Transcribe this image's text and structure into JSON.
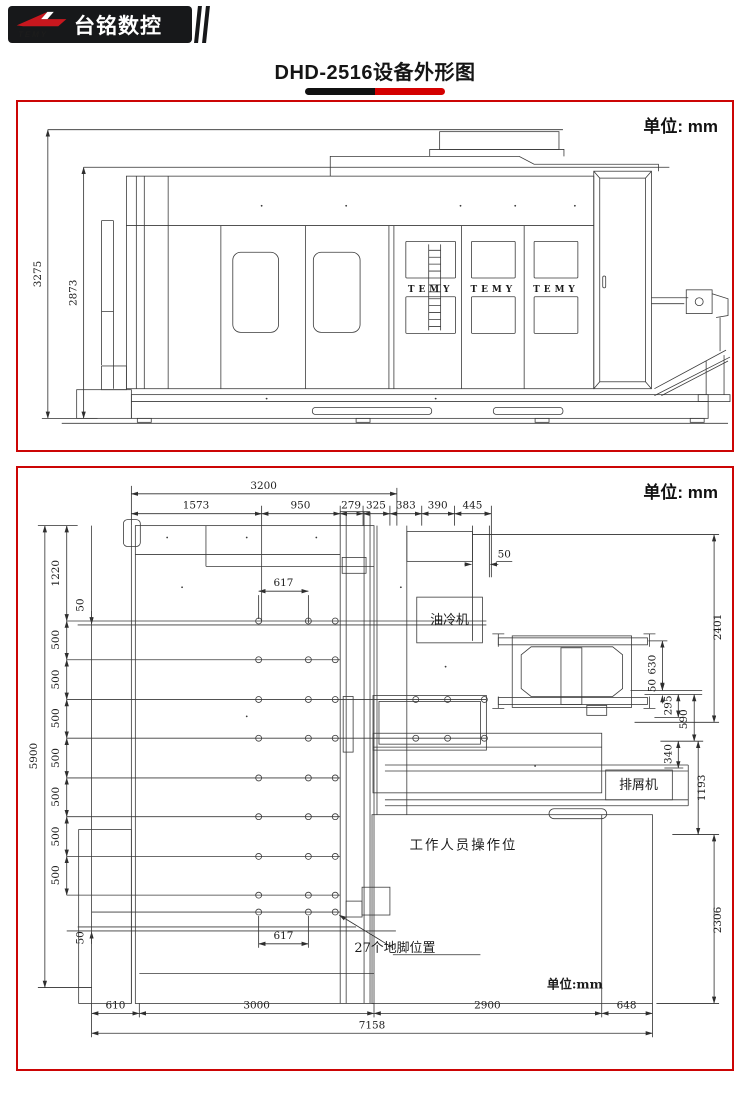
{
  "header": {
    "logo_text": "台铭数控",
    "logo_mark": "TEMY",
    "title": "DHD-2516设备外形图"
  },
  "side_view": {
    "unit_label": "单位: mm",
    "total_height": "3275",
    "body_height": "2873",
    "panel_brand": "TEMY"
  },
  "plan_view": {
    "unit_label": "单位: mm",
    "unit_note": "单位:mm",
    "width_total": "3200",
    "top_chain": [
      "1573",
      "950",
      "279",
      "325",
      "383",
      "390",
      "445"
    ],
    "depth_total": "5900",
    "left_chain": [
      "1220",
      "500",
      "500",
      "500",
      "500",
      "500",
      "500",
      "500"
    ],
    "offset_small": "50",
    "pitch_617": "617",
    "bottom_chain": [
      "610",
      "3000",
      "2900",
      "648"
    ],
    "length_total": "7158",
    "right_chain": [
      "2401",
      "630",
      "50",
      "295",
      "590",
      "340",
      "1193",
      "2306"
    ],
    "oil_cooler": "油冷机",
    "chip_conveyor": "排屑机",
    "operator_area": "工作人员操作位",
    "anchor_note": "27个地脚位置"
  }
}
